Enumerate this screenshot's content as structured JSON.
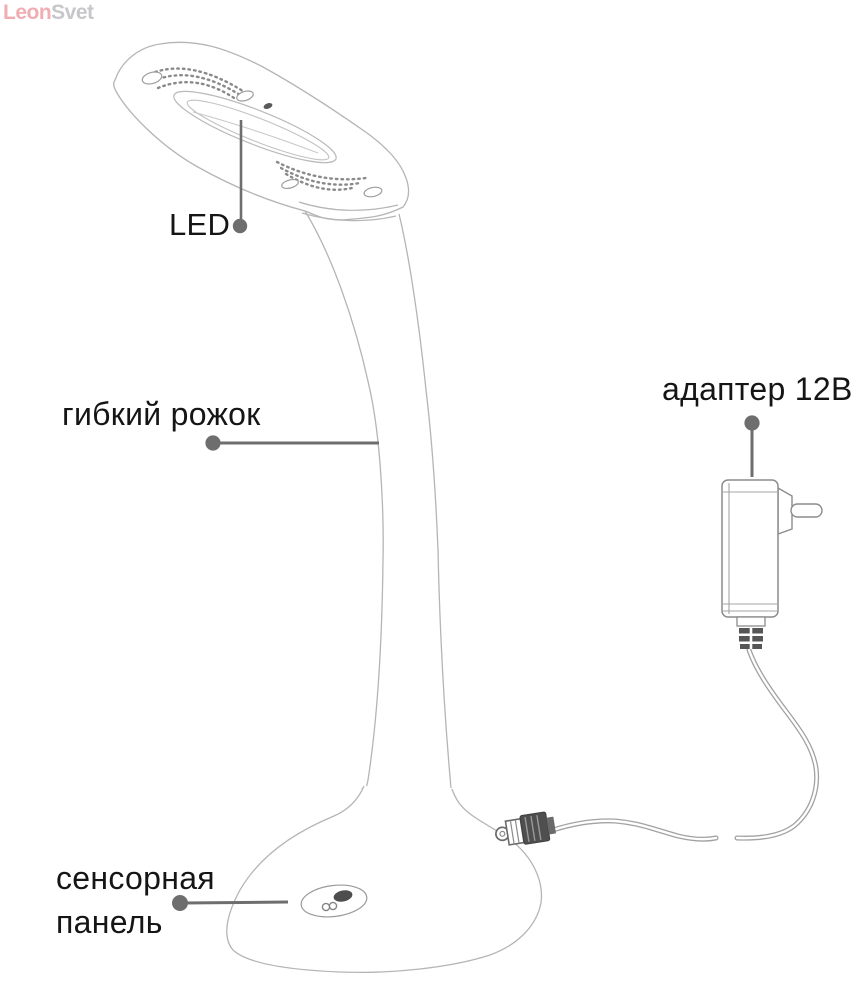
{
  "watermark": {
    "part1": "Leon",
    "part2": "Svet",
    "color_part1": "#f0aeb3",
    "color_part2": "#c7c7ca"
  },
  "labels": {
    "led": "LED",
    "flexible_arm": "гибкий рожок",
    "adapter": "адаптер 12В",
    "touch_panel_line1": "сенсорная",
    "touch_panel_line2": "панель"
  },
  "colors": {
    "label_text": "#151515",
    "callout_gray": "#6e6e6e",
    "lineart_light_gray": "#b5b5b5",
    "lineart_medium_gray": "#8f8f8f",
    "detail_dark_gray": "#4f4f4f",
    "watermark_pink": "#f0aeb3",
    "watermark_gray": "#c7c7ca"
  },
  "diagram": {
    "subject": "LED desk lamp parts diagram",
    "callouts": [
      {
        "label": "LED",
        "points_to": "lamp head light panel"
      },
      {
        "label": "гибкий рожок",
        "points_to": "flexible gooseneck arm"
      },
      {
        "label": "адаптер 12В",
        "points_to": "power adapter"
      },
      {
        "label": "сенсорная панель",
        "points_to": "touch panel on base"
      }
    ]
  }
}
